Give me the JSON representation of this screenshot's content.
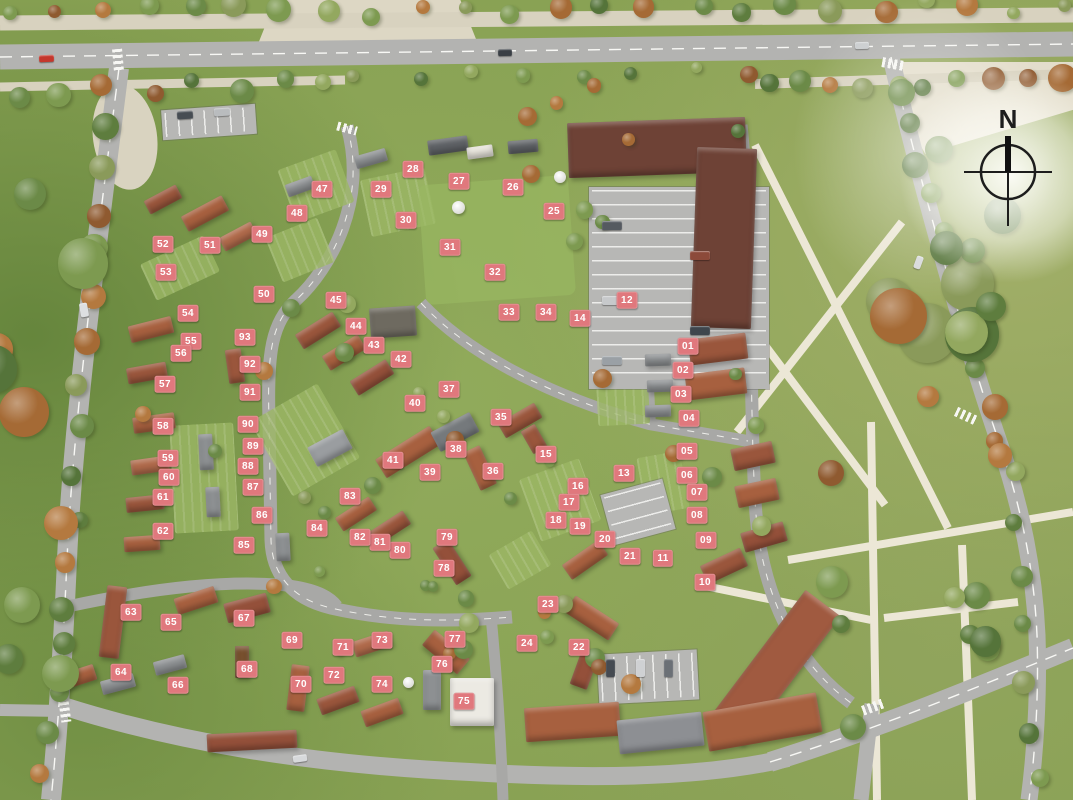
{
  "compass": {
    "label": "N"
  },
  "palette": {
    "marker_bg": "#e0787d",
    "marker_text": "#ffffff",
    "grass": "#88a153",
    "road_gray": "#b3b3b1",
    "path_beige": "#d8d2bf",
    "roof_terracotta": "#a7603f",
    "roof_dark_brown": "#6e4236",
    "roof_gray": "#8d9092"
  },
  "markers": [
    {
      "n": "01",
      "x": 688,
      "y": 346
    },
    {
      "n": "02",
      "x": 683,
      "y": 370
    },
    {
      "n": "03",
      "x": 681,
      "y": 394
    },
    {
      "n": "04",
      "x": 689,
      "y": 418
    },
    {
      "n": "05",
      "x": 687,
      "y": 451
    },
    {
      "n": "06",
      "x": 687,
      "y": 475
    },
    {
      "n": "07",
      "x": 697,
      "y": 492
    },
    {
      "n": "08",
      "x": 697,
      "y": 515
    },
    {
      "n": "09",
      "x": 706,
      "y": 540
    },
    {
      "n": "10",
      "x": 705,
      "y": 582
    },
    {
      "n": "11",
      "x": 663,
      "y": 558
    },
    {
      "n": "12",
      "x": 627,
      "y": 300
    },
    {
      "n": "13",
      "x": 624,
      "y": 473
    },
    {
      "n": "14",
      "x": 580,
      "y": 318
    },
    {
      "n": "15",
      "x": 546,
      "y": 454
    },
    {
      "n": "16",
      "x": 578,
      "y": 486
    },
    {
      "n": "17",
      "x": 569,
      "y": 502
    },
    {
      "n": "18",
      "x": 556,
      "y": 520
    },
    {
      "n": "19",
      "x": 580,
      "y": 526
    },
    {
      "n": "20",
      "x": 605,
      "y": 539
    },
    {
      "n": "21",
      "x": 630,
      "y": 556
    },
    {
      "n": "22",
      "x": 579,
      "y": 647
    },
    {
      "n": "23",
      "x": 548,
      "y": 604
    },
    {
      "n": "24",
      "x": 527,
      "y": 643
    },
    {
      "n": "25",
      "x": 554,
      "y": 211
    },
    {
      "n": "26",
      "x": 513,
      "y": 187
    },
    {
      "n": "27",
      "x": 459,
      "y": 181
    },
    {
      "n": "28",
      "x": 413,
      "y": 169
    },
    {
      "n": "29",
      "x": 381,
      "y": 189
    },
    {
      "n": "30",
      "x": 406,
      "y": 220
    },
    {
      "n": "31",
      "x": 450,
      "y": 247
    },
    {
      "n": "32",
      "x": 495,
      "y": 272
    },
    {
      "n": "33",
      "x": 509,
      "y": 312
    },
    {
      "n": "34",
      "x": 546,
      "y": 312
    },
    {
      "n": "35",
      "x": 501,
      "y": 417
    },
    {
      "n": "36",
      "x": 493,
      "y": 471
    },
    {
      "n": "37",
      "x": 449,
      "y": 389
    },
    {
      "n": "38",
      "x": 456,
      "y": 449
    },
    {
      "n": "39",
      "x": 430,
      "y": 472
    },
    {
      "n": "40",
      "x": 415,
      "y": 403
    },
    {
      "n": "41",
      "x": 393,
      "y": 460
    },
    {
      "n": "42",
      "x": 401,
      "y": 359
    },
    {
      "n": "43",
      "x": 374,
      "y": 345
    },
    {
      "n": "44",
      "x": 356,
      "y": 326
    },
    {
      "n": "45",
      "x": 336,
      "y": 300
    },
    {
      "n": "47",
      "x": 322,
      "y": 189
    },
    {
      "n": "48",
      "x": 297,
      "y": 213
    },
    {
      "n": "49",
      "x": 262,
      "y": 234
    },
    {
      "n": "50",
      "x": 264,
      "y": 294
    },
    {
      "n": "51",
      "x": 210,
      "y": 245
    },
    {
      "n": "52",
      "x": 163,
      "y": 244
    },
    {
      "n": "53",
      "x": 166,
      "y": 272
    },
    {
      "n": "54",
      "x": 188,
      "y": 313
    },
    {
      "n": "55",
      "x": 191,
      "y": 341
    },
    {
      "n": "56",
      "x": 181,
      "y": 353
    },
    {
      "n": "57",
      "x": 165,
      "y": 384
    },
    {
      "n": "58",
      "x": 163,
      "y": 426
    },
    {
      "n": "59",
      "x": 168,
      "y": 458
    },
    {
      "n": "60",
      "x": 169,
      "y": 477
    },
    {
      "n": "61",
      "x": 163,
      "y": 497
    },
    {
      "n": "62",
      "x": 163,
      "y": 531
    },
    {
      "n": "63",
      "x": 131,
      "y": 612
    },
    {
      "n": "64",
      "x": 121,
      "y": 672
    },
    {
      "n": "65",
      "x": 171,
      "y": 622
    },
    {
      "n": "66",
      "x": 178,
      "y": 685
    },
    {
      "n": "67",
      "x": 244,
      "y": 618
    },
    {
      "n": "68",
      "x": 247,
      "y": 669
    },
    {
      "n": "69",
      "x": 292,
      "y": 640
    },
    {
      "n": "70",
      "x": 301,
      "y": 684
    },
    {
      "n": "71",
      "x": 343,
      "y": 647
    },
    {
      "n": "72",
      "x": 334,
      "y": 675
    },
    {
      "n": "73",
      "x": 382,
      "y": 640
    },
    {
      "n": "74",
      "x": 382,
      "y": 684
    },
    {
      "n": "75",
      "x": 464,
      "y": 701
    },
    {
      "n": "76",
      "x": 442,
      "y": 664
    },
    {
      "n": "77",
      "x": 455,
      "y": 639
    },
    {
      "n": "78",
      "x": 444,
      "y": 568
    },
    {
      "n": "79",
      "x": 447,
      "y": 537
    },
    {
      "n": "80",
      "x": 400,
      "y": 550
    },
    {
      "n": "81",
      "x": 380,
      "y": 542
    },
    {
      "n": "82",
      "x": 360,
      "y": 537
    },
    {
      "n": "83",
      "x": 350,
      "y": 496
    },
    {
      "n": "84",
      "x": 317,
      "y": 528
    },
    {
      "n": "85",
      "x": 244,
      "y": 545
    },
    {
      "n": "86",
      "x": 262,
      "y": 515
    },
    {
      "n": "87",
      "x": 253,
      "y": 487
    },
    {
      "n": "88",
      "x": 248,
      "y": 466
    },
    {
      "n": "89",
      "x": 253,
      "y": 446
    },
    {
      "n": "90",
      "x": 248,
      "y": 424
    },
    {
      "n": "91",
      "x": 250,
      "y": 392
    },
    {
      "n": "92",
      "x": 250,
      "y": 364
    },
    {
      "n": "93",
      "x": 245,
      "y": 337
    }
  ]
}
